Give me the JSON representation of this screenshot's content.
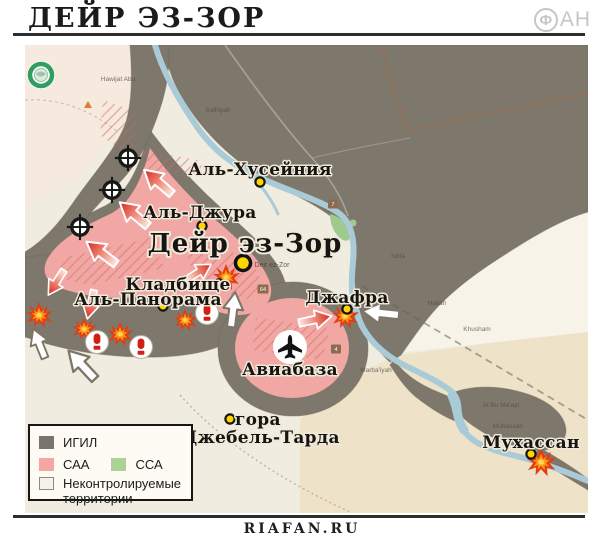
{
  "header": {
    "title": "ДЕЙР ЭЗ-ЗОР",
    "logo": {
      "circled_letter": "Ф",
      "suffix": "АН"
    }
  },
  "map": {
    "place_labels": {
      "husseiniya": "Аль-Хусейния",
      "jura": "Аль-Джура",
      "city": "Дейр эз-Зор",
      "cemetery": "Кладбище",
      "panorama": "Аль-Панорама",
      "jafra": "Джафра",
      "airbase": "Авиабаза",
      "mountain_line1": "гора",
      "mountain_line2": "Джебель-Тарда",
      "muhassan": "Мухассан"
    },
    "base_map_labels": [
      "Hawijat Abu",
      "Salhiyah",
      "Ishla",
      "Khusham",
      "Marba'iyah",
      "Al Bu Ma'ayt",
      "Muhassan",
      "Deir ez-Zor",
      "Hatlah"
    ],
    "road_shields": [
      "7",
      "64",
      "4"
    ],
    "icons": {
      "explosion": "burst-star",
      "artillery": "shell-in-white-circle",
      "target": "crosshair-scope",
      "airbase": "airplane-in-white-circle",
      "globe_badge": "green-globe-rings"
    },
    "colors": {
      "terrain": "#f1ece0",
      "terrain_pink": "#f7e9dc",
      "terrain_beige": "#eee3c9",
      "khusham_wedge": "#f7f3e8",
      "river": "#a9cbd7",
      "igil_zone": "#7e776c",
      "saa_zone": "#f1a8a4",
      "ssa_zone": "#9fca8d",
      "urban_hatch": "#d4685f",
      "poi_dot": "#ffd400"
    }
  },
  "legend": {
    "igil": "ИГИЛ",
    "saa": "САА",
    "ssa": "ССА",
    "uncontrolled_line1": "Неконтролируемые",
    "uncontrolled_line2": "территории",
    "colors": {
      "igil": "#7a746a",
      "saa": "#f4a6a0",
      "ssa": "#abd398",
      "uncontrolled": "#f6f2e5"
    }
  },
  "footer": {
    "watermark": "RIAFAN.RU"
  }
}
